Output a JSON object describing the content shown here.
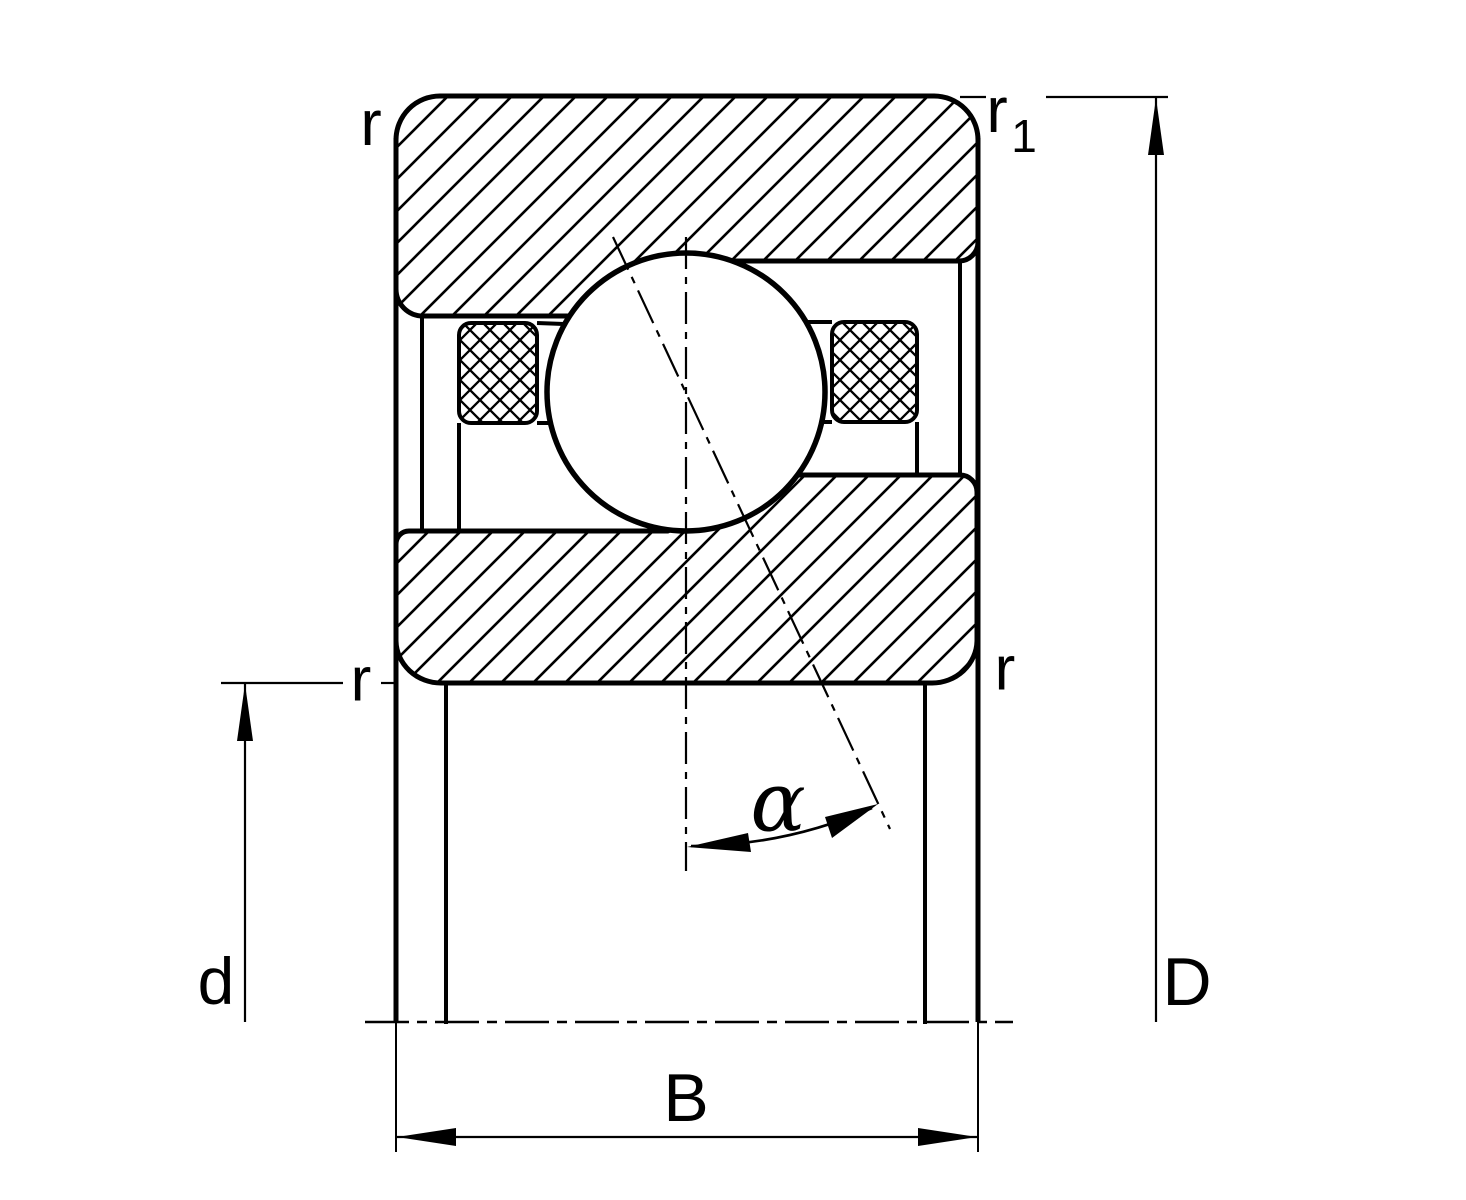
{
  "drawing": {
    "kind": "bearing-cross-section",
    "colors": {
      "ink": "#000000",
      "paper": "#ffffff"
    },
    "labels": {
      "r_top_left": "r",
      "r1_base": "r",
      "r1_sub": "1",
      "r_mid_left": "r",
      "r_mid_right": "r",
      "bore_diameter": "d",
      "outside_diameter": "D",
      "width": "B",
      "contact_angle": "α"
    }
  }
}
